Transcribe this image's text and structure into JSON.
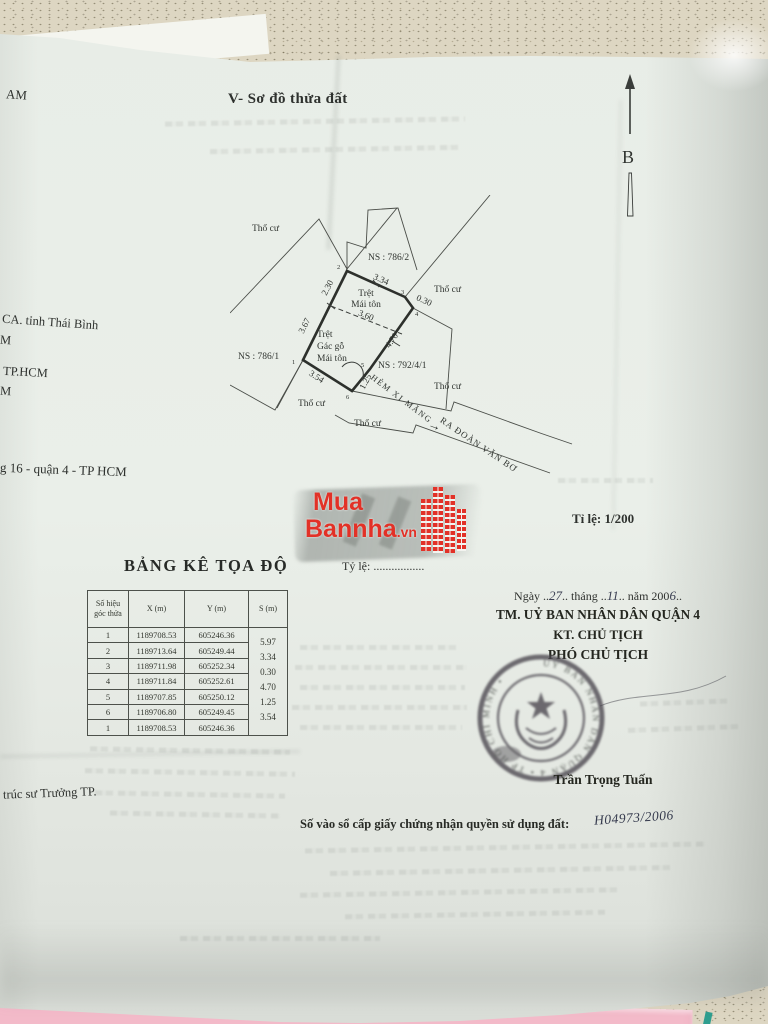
{
  "document": {
    "section_title": "V- Sơ đồ thửa đất",
    "compass_label": "B",
    "scale_note": "Tỉ lệ: 1/200",
    "scale_blank": "Tỷ lệ: .................",
    "coord_table_title": "BẢNG KÊ TỌA ĐỘ"
  },
  "diagram": {
    "land_use_label": "Thổ cư",
    "parcel_786_1": "NS : 786/1",
    "parcel_786_2": "NS : 786/2",
    "parcel_792_4_1": "NS : 792/4/1",
    "structure_top": {
      "line1": "Trệt",
      "line2": "Mái tôn"
    },
    "structure_bottom": {
      "line1": "Trệt",
      "line2": "Gác gỗ",
      "line3": "Mái tôn"
    },
    "alley_name": "HẺM XI MĂNG",
    "alley_direction": "RA ĐOÀN VĂN BƠ",
    "arrow_glyph": "→",
    "dims": {
      "left_upper": "2.30",
      "left_lower": "3.67",
      "top": "3.34",
      "jog": "0.30",
      "right": "4.70",
      "alley_edge": "1.25",
      "bottom": "3.54",
      "interior": "3.60"
    },
    "vertices": {
      "v1": "1",
      "v2": "2",
      "v3": "3",
      "v4": "4",
      "v5": "5",
      "v6": "6"
    }
  },
  "coord_table": {
    "headers": {
      "col1a": "Số hiệu",
      "col1b": "góc thửa",
      "col2": "X (m)",
      "col3": "Y (m)",
      "col4": "S (m)"
    },
    "rows": [
      {
        "id": "1",
        "x": "1189708.53",
        "y": "605246.36"
      },
      {
        "id": "2",
        "x": "1189713.64",
        "y": "605249.44"
      },
      {
        "id": "3",
        "x": "1189711.98",
        "y": "605252.34"
      },
      {
        "id": "4",
        "x": "1189711.84",
        "y": "605252.61"
      },
      {
        "id": "5",
        "x": "1189707.85",
        "y": "605250.12"
      },
      {
        "id": "6",
        "x": "1189706.80",
        "y": "605249.45"
      },
      {
        "id": "1b",
        "x": "1189708.53",
        "y": "605246.36"
      }
    ],
    "row_ids": [
      "1",
      "2",
      "3",
      "4",
      "5",
      "6",
      "1"
    ],
    "edge_lengths": [
      "5.97",
      "3.34",
      "0.30",
      "4.70",
      "1.25",
      "3.54"
    ]
  },
  "approval": {
    "date_parts": {
      "p1": "Ngày ..",
      "day": "27",
      "p2": ".. tháng ..",
      "month": "11",
      "p3": ".. năm 200",
      "year_digit": "6",
      "p4": ".."
    },
    "authority": "TM. UỶ BAN NHÂN DÂN QUẬN 4",
    "on_behalf": "KT. CHỦ TỊCH",
    "signer_title": "PHÓ CHỦ TỊCH",
    "signer_name": "Trần Trọng Tuấn",
    "stamp_ring_text": "UỶ BAN NHÂN DÂN QUẬN 4 • TP HỒ CHÍ MINH •"
  },
  "registry": {
    "label": "Số vào sổ cấp giấy chứng nhận quyền sử dụng đất:",
    "number": "H04973/2006"
  },
  "edge_fragments": {
    "f1": "AM",
    "f2": "CA. tỉnh Thái Bình",
    "f3": "M",
    "f4": "TP.HCM",
    "f5": "M",
    "f6": "g 16 - quận 4 - TP HCM",
    "f7": "trúc sư Trưởng TP."
  },
  "watermark": {
    "word1": "Mua",
    "word2": "Bannha",
    "tld": ".vn",
    "brand_color": "#e23127"
  }
}
